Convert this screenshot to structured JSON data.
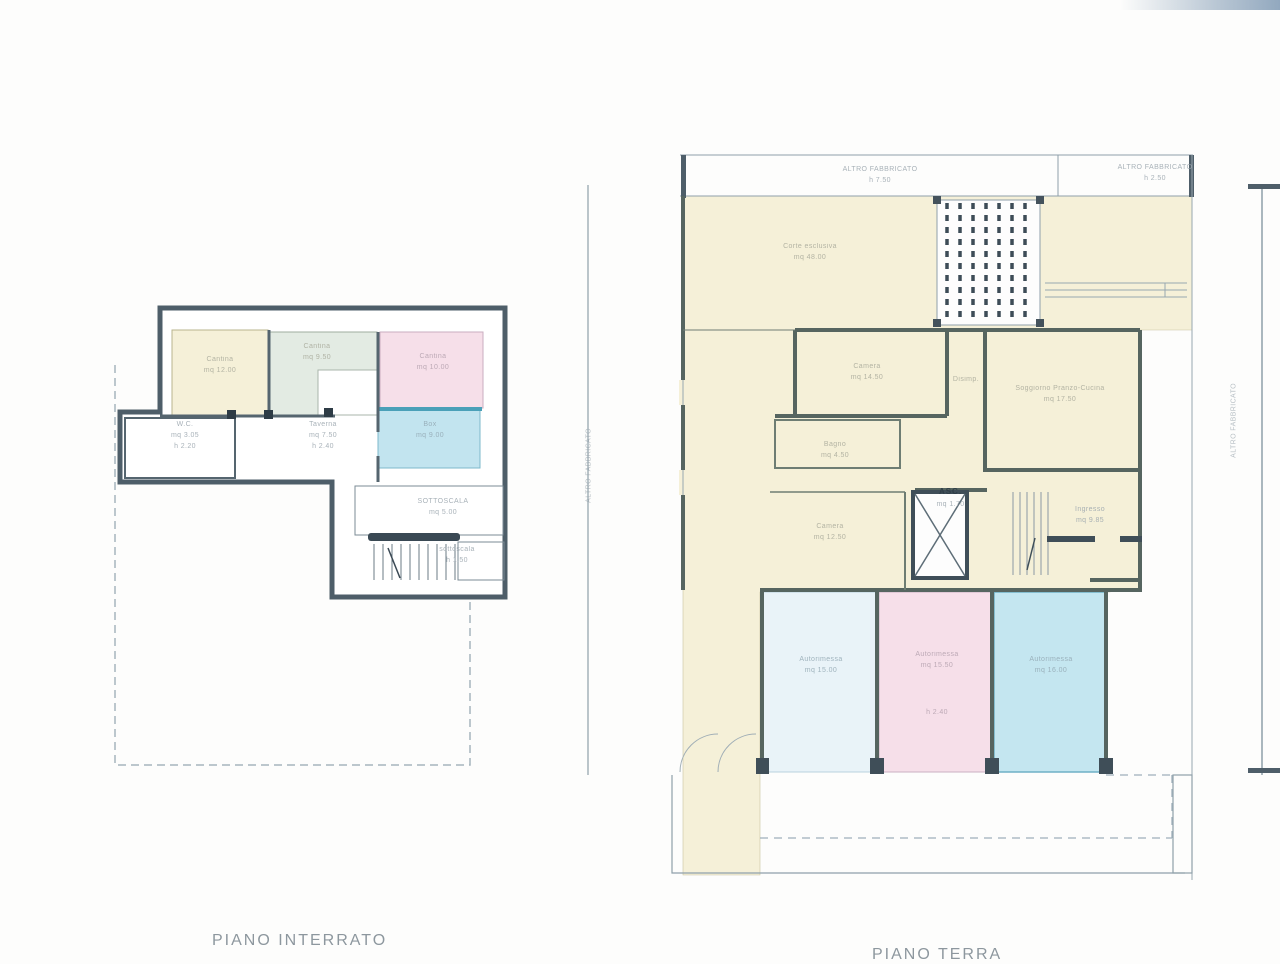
{
  "captions": {
    "interrato": "PIANO INTERRATO",
    "terra": "PIANO TERRA"
  },
  "neighbors": {
    "top_left_1": "ALTRO FABBRICATO",
    "top_left_2": "h 7.50",
    "top_right_1": "ALTRO FABBRICATO",
    "top_right_2": "h 2.50",
    "side_left": "ALTRO FABBRICATO",
    "side_right": "ALTRO FABBRICATO"
  },
  "interrato": {
    "rooms": {
      "cantina_a": {
        "name": "Cantina",
        "area": "mq 12.00"
      },
      "cantina_b": {
        "name": "Cantina",
        "area": "mq 9.50"
      },
      "cantina_c": {
        "name": "Cantina",
        "area": "mq 10.00"
      },
      "box": {
        "name": "Box",
        "area": "mq 9.00"
      },
      "wc": {
        "name": "W.C.",
        "area": "mq 3.05",
        "h": "h 2.20"
      },
      "taverna": {
        "name": "Taverna",
        "area": "mq 7.50",
        "h": "h 2.40"
      },
      "sottoscala": {
        "name": "SOTTOSCALA",
        "area": "mq 5.00"
      },
      "sottoscala2": {
        "name": "sottoscala",
        "h": "h 1.50"
      }
    }
  },
  "terra": {
    "rooms": {
      "corte": {
        "name": "Corte esclusiva",
        "area": "mq 48.00"
      },
      "camera1": {
        "name": "Camera",
        "area": "mq 14.50"
      },
      "disimpegno": {
        "name": "Disimp."
      },
      "soggiorno": {
        "name": "Soggiorno Pranzo-Cucina",
        "area": "mq 17.50"
      },
      "bagno": {
        "name": "Bagno",
        "area": "mq 4.50"
      },
      "camera2": {
        "name": "Camera",
        "area": "mq 12.50"
      },
      "ascensore": {
        "stamp": "ASC.",
        "area": "mq 1.70"
      },
      "ingresso": {
        "name": "Ingresso",
        "area": "mq 9.85"
      },
      "autorimessa1": {
        "name": "Autorimessa",
        "area": "mq 15.00"
      },
      "autorimessa2": {
        "name": "Autorimessa",
        "area": "mq 15.50",
        "h": "h 2.40"
      },
      "autorimessa3": {
        "name": "Autorimessa",
        "area": "mq 16.00"
      }
    }
  },
  "colors": {
    "wall": "#4e5e69",
    "cream": "#f5f0d8",
    "pink": "#f6dfe9",
    "teal": "#c2e4ef",
    "pale_blue": "#e9f3f8",
    "sage": "#e3ebe3"
  }
}
